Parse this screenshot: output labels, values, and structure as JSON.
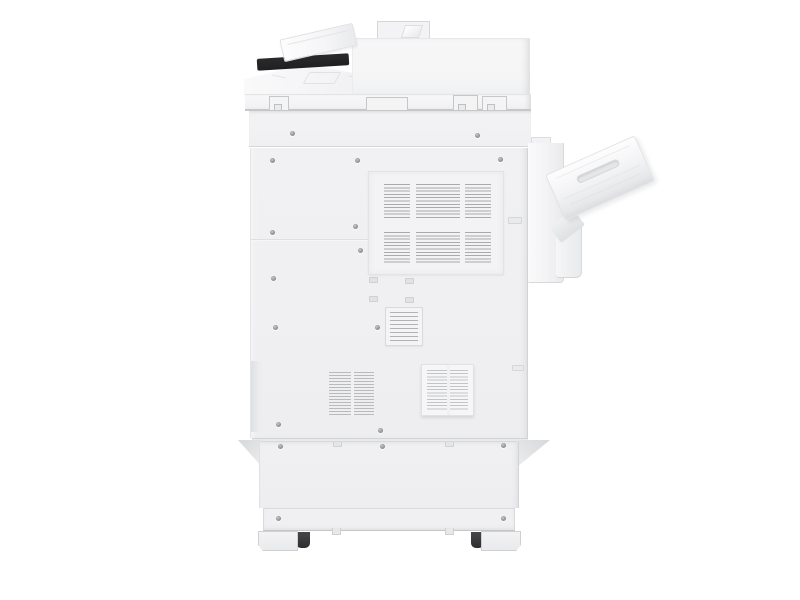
{
  "image": {
    "alt": "Rear view photo of a white multifunction office printer copier on a plain white background, with automatic document feeder and angled input tray on top, a dark paper slot, an angled side output tray on the right, large slatted ventilation grilles, screws across the back panels, stabilizer brackets and caster feet at the base",
    "background": "#ffffff"
  },
  "colors": {
    "bg": "#ffffff",
    "body": "#f2f2f4",
    "body-light": "#fafafb",
    "panel": "#f1f1f3",
    "edge": "#d5d6d8",
    "edge-dark": "#c6c7c9",
    "slat": "#a9aaac",
    "slat-light": "#b9babc",
    "dark-strip": "#1f1f21",
    "caster": "#2e2e30",
    "screw": "#939496"
  },
  "parts": [
    "adf-input-tray",
    "adf-body",
    "adf-hinge",
    "document-feed-slot",
    "scanner-lid",
    "scanner-front",
    "latch-tabs",
    "rear-panel",
    "main-vent-grille",
    "small-vent-grille",
    "left-vent-grille",
    "framed-vent-grille",
    "handle-recess",
    "screws",
    "base-cabinet",
    "kick-plate",
    "stabilizer-wings",
    "caster-feet",
    "casters",
    "finisher-column",
    "output-tray"
  ]
}
